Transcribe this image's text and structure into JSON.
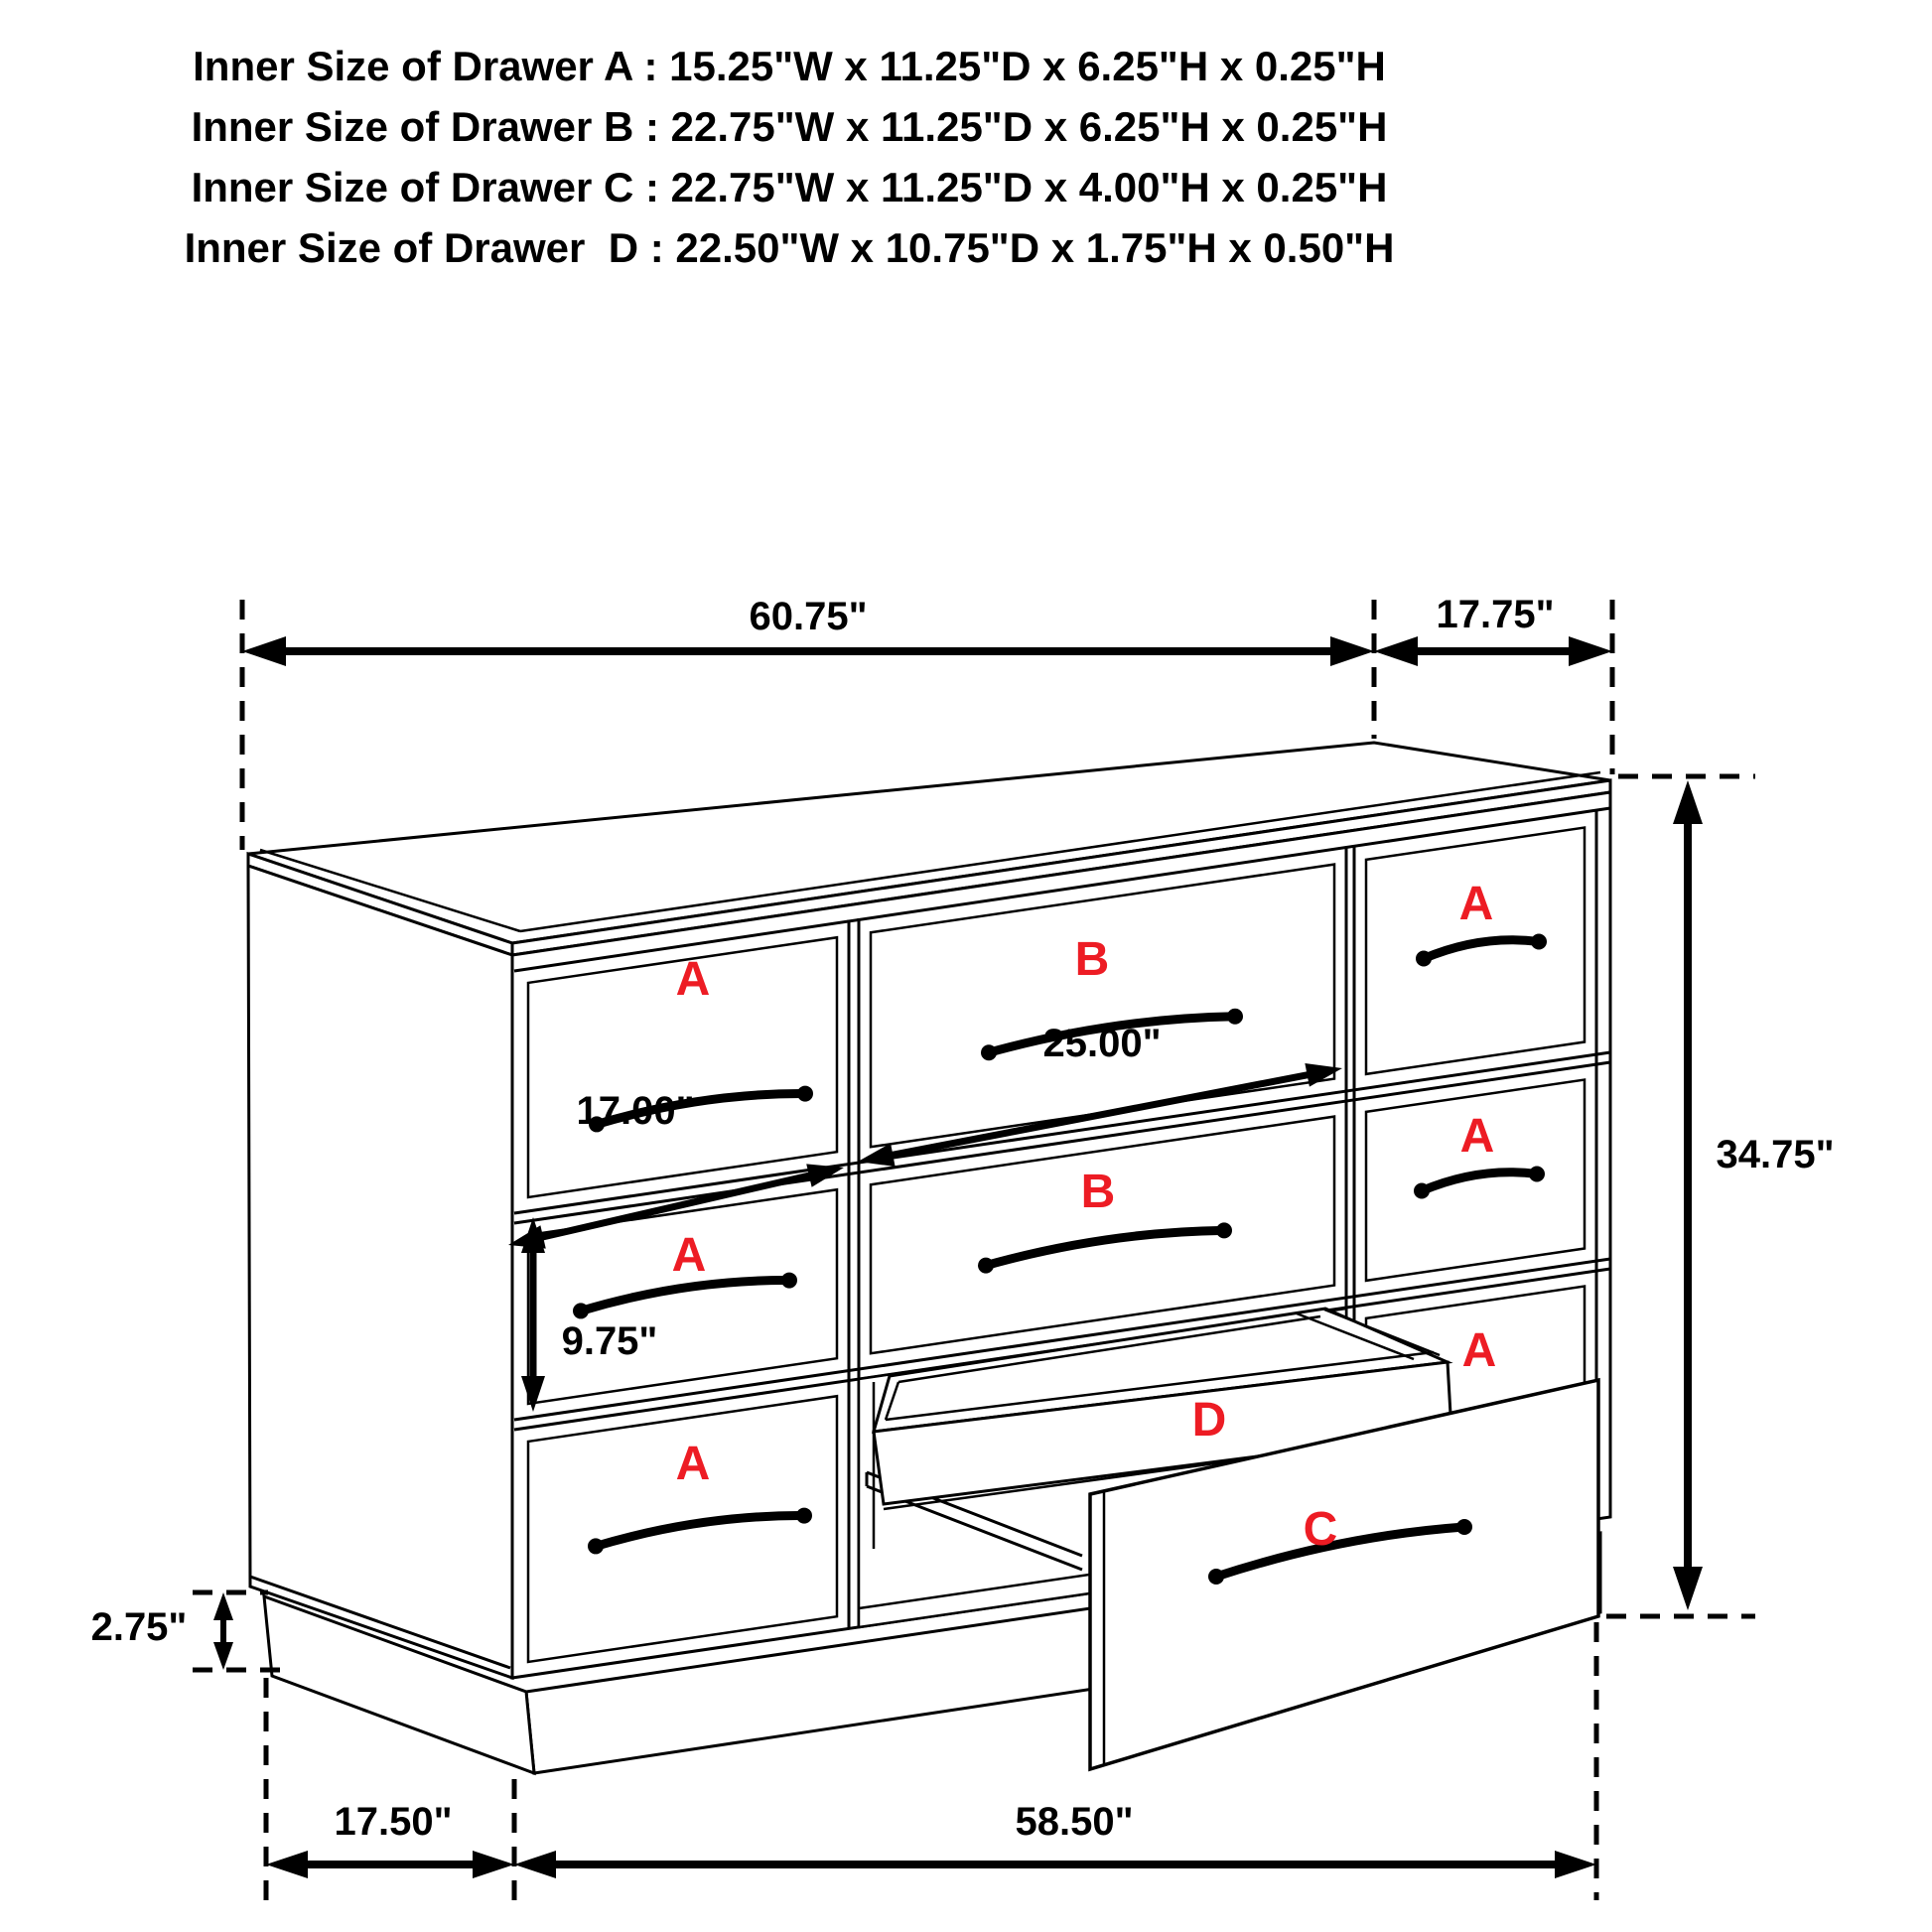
{
  "header": {
    "lines": [
      "Inner Size of Drawer A : 15.25\"W x 11.25\"D x 6.25\"H x 0.25\"H",
      "Inner Size of Drawer B : 22.75\"W x 11.25\"D x 6.25\"H x 0.25\"H",
      "Inner Size of Drawer C : 22.75\"W x 11.25\"D x 4.00\"H x 0.25\"H",
      "Inner Size of Drawer  D : 22.50\"W x 10.75\"D x 1.75\"H x 0.50\"H"
    ]
  },
  "dimensions": {
    "top_width": "60.75\"",
    "top_depth": "17.75\"",
    "height": "34.75\"",
    "left_drawer_width": "17.00\"",
    "middle_drawer_width": "25.00\"",
    "middle_drawer_height": "9.75\"",
    "base_height": "2.75\"",
    "bottom_depth": "17.50\"",
    "bottom_width": "58.50\""
  },
  "drawers": {
    "left_column": [
      "A",
      "A",
      "A"
    ],
    "middle_column": [
      "B",
      "B"
    ],
    "right_column": [
      "A",
      "A",
      "A"
    ],
    "pulled": [
      "D",
      "C"
    ]
  },
  "colors": {
    "line": "#000000",
    "label_red": "#ed1c24",
    "background": "#ffffff"
  }
}
